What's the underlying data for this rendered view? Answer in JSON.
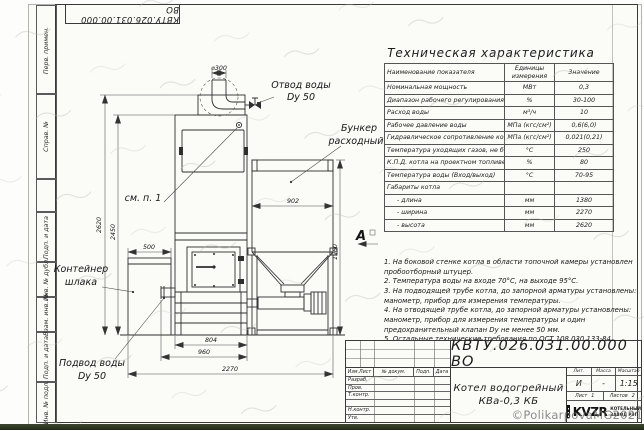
{
  "designation": "КВТУ.026.031.00.000 ВО",
  "sheet": {
    "margin_fields": [
      "Перв. примен.",
      "Справ. №",
      "Подп. и дата",
      "Инв. № дубл.",
      "Взам. инв. №",
      "Подп. и дата",
      "Инв. № подл."
    ]
  },
  "table": {
    "title": "Техническая характеристика",
    "headers": [
      "Наименование показателя",
      "Единицы измерения",
      "Значение"
    ],
    "rows": [
      {
        "name": "Номинальная мощность",
        "units": "МВт",
        "value": "0,3"
      },
      {
        "name": "Диапазон рабочего регулирования",
        "units": "%",
        "value": "30-100"
      },
      {
        "name": "Расход воды",
        "units": "м³/ч",
        "value": "10"
      },
      {
        "name": "Рабочее давление воды",
        "units": "МПа (кгс/см²)",
        "value": "0,6(6,0)"
      },
      {
        "name": "Гидравлическое сопротивление котла",
        "units": "МПа (кгс/см²)",
        "value": "0,021(0,21)"
      },
      {
        "name": "Температура уходящих газов, не более",
        "units": "°С",
        "value": "250"
      },
      {
        "name": "К.П.Д. котла на проектном топливе",
        "units": "%",
        "value": "80"
      },
      {
        "name": "Температура воды (Вход/выход)",
        "units": "°С",
        "value": "70-95"
      },
      {
        "name": "Габариты котла",
        "units": "",
        "value": ""
      },
      {
        "name": "- длина",
        "units": "мм",
        "value": "1380"
      },
      {
        "name": "- ширина",
        "units": "мм",
        "value": "2270"
      },
      {
        "name": "- высота",
        "units": "мм",
        "value": "2620"
      }
    ]
  },
  "notes": {
    "items": [
      "1.  На боковой стенке котла в области топочной камеры установлен пробоотборный штуцер.",
      "2.  Температура воды на входе 70°С, на выходе 95°С.",
      "3.  На подводящей трубе котла, до запорной арматуры установлены: манометр, прибор для измерения температуры.",
      "4.  На отводящей трубе котла, до запорной арматуры установлены: манометр, прибор для измерения температуры и один предохранительный клапан Dy не менее 50 мм.",
      "5.  Остальные технические требования по ОСТ 108.030.133-84."
    ]
  },
  "drawing": {
    "dims": {
      "d300": "⌀300",
      "h2620": "2620",
      "h2450": "2450",
      "w500": "500",
      "w902": "902",
      "h1960": "1960",
      "w804": "804",
      "w960": "960",
      "w2270": "2270"
    },
    "labels": {
      "otvod1": "Отвод воды",
      "otvod2": "Dy 50",
      "bunker1": "Бункер",
      "bunker2": "расходный",
      "see_note": "см. п. 1",
      "container1": "Контейнер",
      "container2": "шлака",
      "podvod1": "Подвод воды",
      "podvod2": "Dy 50",
      "view": "А"
    }
  },
  "title_block": {
    "doc_title_line1": "Котел водогрейный",
    "doc_title_line2": "КВа-0,3 КБ",
    "header_cells": [
      "Изм.Лист",
      "№ докум.",
      "Подп.",
      "Дата"
    ],
    "staff_rows": [
      "Разраб.",
      "Пров.",
      "Т.контр.",
      "",
      "Н.контр.",
      "Утв."
    ],
    "lit_label": "Лит.",
    "mass_label": "Масса",
    "scale_label": "Масштаб",
    "lit_value": "И",
    "mass_value": "-",
    "scale_value": "1:15",
    "sheet_label": "Лист",
    "sheet_value": "1",
    "sheets_label": "Листов",
    "sheets_value": "2",
    "company": {
      "logo_text": "KVZR",
      "line1": "КОТЕЛЬНЫЙ",
      "line2": "ЗАВОД РЭП"
    }
  },
  "watermark": "©PolikarpovaMG2021"
}
